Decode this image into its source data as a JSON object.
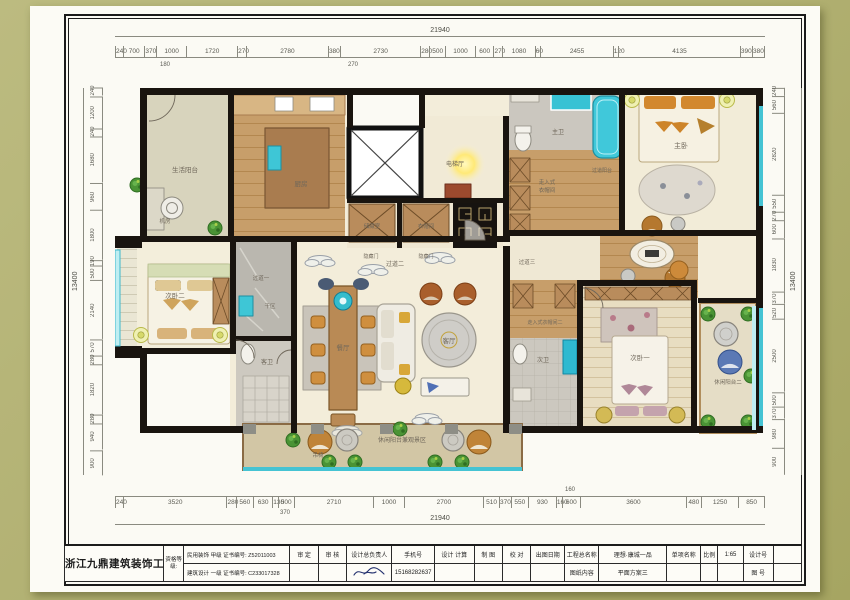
{
  "sheet": {
    "company": "浙江九鼎建筑装饰工程有限公司",
    "qualification_label": "资格等级:",
    "qual_line1": "民用装饰  甲级  证书编号: Z52011003",
    "qual_line2": "建筑设计  一级  证书编号: C233017328",
    "fields": {
      "approve_label": "审  定",
      "review_label": "审  核",
      "chief_label": "设计总负责人",
      "phone_label": "手机号",
      "phone": "15168282637",
      "design_calc_label": "设计  计算",
      "draft_label": "制  图",
      "proof_label": "校  对",
      "issue_date_label": "出图日期",
      "project_label": "工程总名称",
      "project_name": "理想·康城一品",
      "item_label": "单项名称",
      "scale_label": "比例",
      "scale": "1:65",
      "content_label": "图纸内容",
      "content": "平面方案三",
      "design_no_label": "设计号",
      "figure_no_label": "图  号"
    }
  },
  "dims": {
    "h_total": "21940",
    "v_total": "13400",
    "top": [
      240,
      700,
      370,
      1000,
      1720,
      270,
      2780,
      380,
      2730,
      280,
      500,
      1000,
      600,
      270,
      1080,
      60,
      2455,
      120,
      4135,
      390,
      380
    ],
    "bottom": [
      240,
      3520,
      280,
      560,
      630,
      130,
      500,
      2710,
      1000,
      2700,
      510,
      370,
      550,
      930,
      160,
      600,
      3600,
      480,
      1250,
      850
    ],
    "left": [
      240,
      1200,
      240,
      1680,
      960,
      1800,
      190,
      500,
      2140,
      570,
      280,
      1820,
      280,
      940,
      900
    ],
    "right": [
      240,
      560,
      2820,
      550,
      270,
      600,
      1830,
      370,
      520,
      2500,
      500,
      370,
      980,
      900
    ],
    "top_subs": [
      "180",
      "270"
    ],
    "bottom_subs": [
      "370",
      "160"
    ]
  },
  "rooms": {
    "service_balcony": "生活阳台",
    "machine_room": "机房",
    "kitchen": "厨房",
    "elevator_hall": "电梯厅",
    "storage": "储藏室",
    "cloakroom": "衣帽间",
    "hidden_door": "隐藏门",
    "corridor1": "过道一",
    "corridor2": "过道二",
    "corridor3": "过道三",
    "dry_area": "干区",
    "guest_bath": "客卫",
    "bedroom2": "次卧二",
    "dining": "餐厅",
    "living": "客厅",
    "master_bath": "主卫",
    "corridor_balcony": "过道阳台",
    "walkin1_l1": "走入式",
    "walkin1_l2": "衣帽间",
    "master_bedroom": "主卧",
    "bedroom1": "次卧一",
    "bath2": "次卫",
    "walkin2": "走入式衣帽间二",
    "leisure_balcony2": "休闲阳台二",
    "view_balcony": "休闲阳台兼观景区",
    "hanging_chair": "吊椅"
  },
  "colors": {
    "background_olive": "#b2b173",
    "paper": "#fcfbf5",
    "wall_black": "#19140f",
    "window_teal": "#45c3d3",
    "wood": "#c79e6a",
    "floor_cream": "#f3edda",
    "accent_orange": "#cd8a3a"
  }
}
